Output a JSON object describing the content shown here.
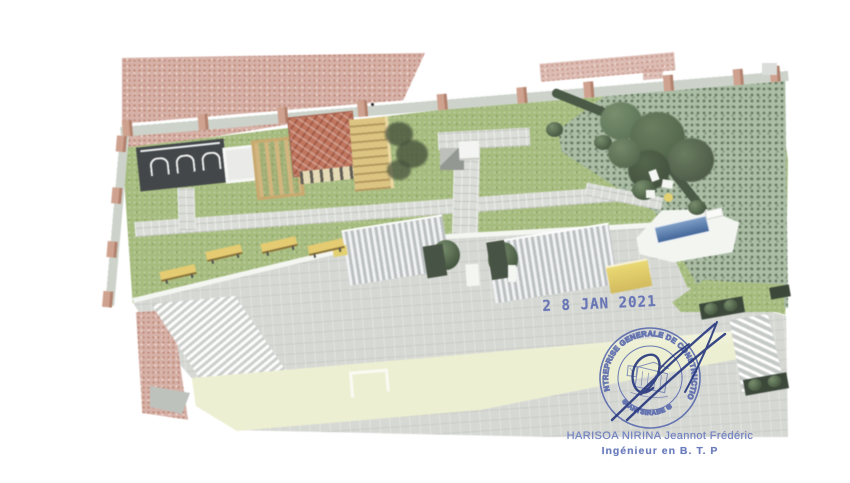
{
  "document": {
    "kind_label": "scanned aerial 3D rendering of a walled garden courtyard",
    "page_background": "#ffffff"
  },
  "stamps": {
    "date_stamp": {
      "text": "2 8 JAN 2021",
      "ink_color": "#5565b0"
    },
    "round_stamp": {
      "arc_text": "ENTREPRISE GENERALE DE CONSTRUCTION",
      "bottom_arc_text": "✱ ANTSIRABE ✱",
      "ink_color": "#4d5fa9"
    },
    "signature": {
      "ink_color": "#25367d"
    },
    "signatory": {
      "name": "HARISOA NIRINA Jeannot Frédéric",
      "title": "Ingénieur en B. T. P",
      "ink_color": "#7282c0"
    }
  },
  "scene": {
    "colors": {
      "lawn": "#9dbb67",
      "paths_and_plaza": "#d6d9d2",
      "neighbor_roof_pink": "#ddab9e",
      "perimeter_wall": "#c9d2c6",
      "wall_pillars": "#d89b82",
      "kiosk_red_roof": "#cf6a4a",
      "wood_pergola": "#d8b266",
      "benches_yellow": "#ecc94f",
      "pool_blue": "#3f6fb0",
      "hedge_dark_green": "#3e5338",
      "vegetation": "#a3bb9b",
      "shed_roofs": "#e8ebec",
      "front_wall_pale_yellow": "#edefc9",
      "carport_dark": "#383d40"
    },
    "features": [
      "neighbor tiled roof",
      "perimeter wall with pillars",
      "carport with white arches",
      "white screen",
      "wood pergola",
      "red tiled kiosk roof",
      "yellow play structure",
      "lawn with paved paths",
      "monument cubes",
      "shrub planters",
      "large tree",
      "swimming pool with deck",
      "striped shed roofs",
      "yellow benches",
      "corrugated white roof",
      "pale yellow front wall",
      "trellis with planters"
    ]
  }
}
